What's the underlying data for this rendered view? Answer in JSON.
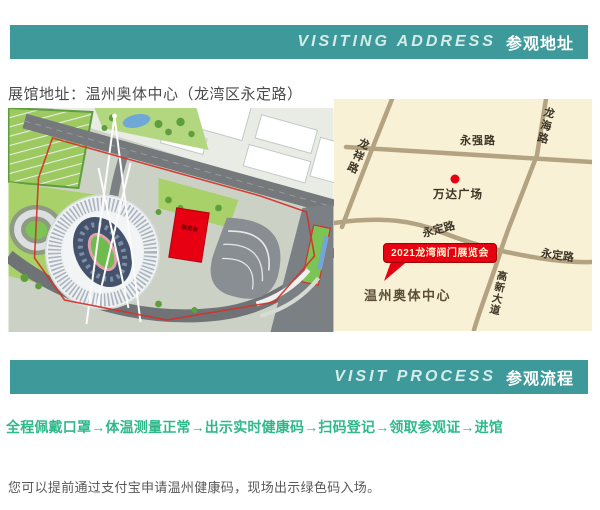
{
  "banner_visiting": {
    "en": "VISITING ADDRESS",
    "zh": "参观地址"
  },
  "banner_process": {
    "en": "VISIT PROCESS",
    "zh": "参观流程"
  },
  "address_line": "展馆地址：温州奥体中心（龙湾区永定路）",
  "site_plan": {
    "building_label": "展览会"
  },
  "map": {
    "road_yongqiang": "永强路",
    "road_longhai": "龙海路",
    "road_longxiang": "龙祥路",
    "road_yongding_left": "永定路",
    "road_yongding_right": "永定路",
    "road_gaoxin": "高新大道",
    "poi_wanda": "万达广场",
    "badge_label": "2021龙湾阀门展览会",
    "venue_label": "温州奥体中心"
  },
  "process_line": "全程佩戴口罩→体温测量正常→出示实时健康码→扫码登记→领取参观证→进馆",
  "note_line": "您可以提前通过支付宝申请温州健康码，现场出示绿色码入场。",
  "colors": {
    "banner_teal": "#3e9a9a",
    "accent_green": "#2fb98a",
    "map_bg": "#f8f1d5",
    "map_road": "#b4a383",
    "badge_red": "#e60012"
  }
}
